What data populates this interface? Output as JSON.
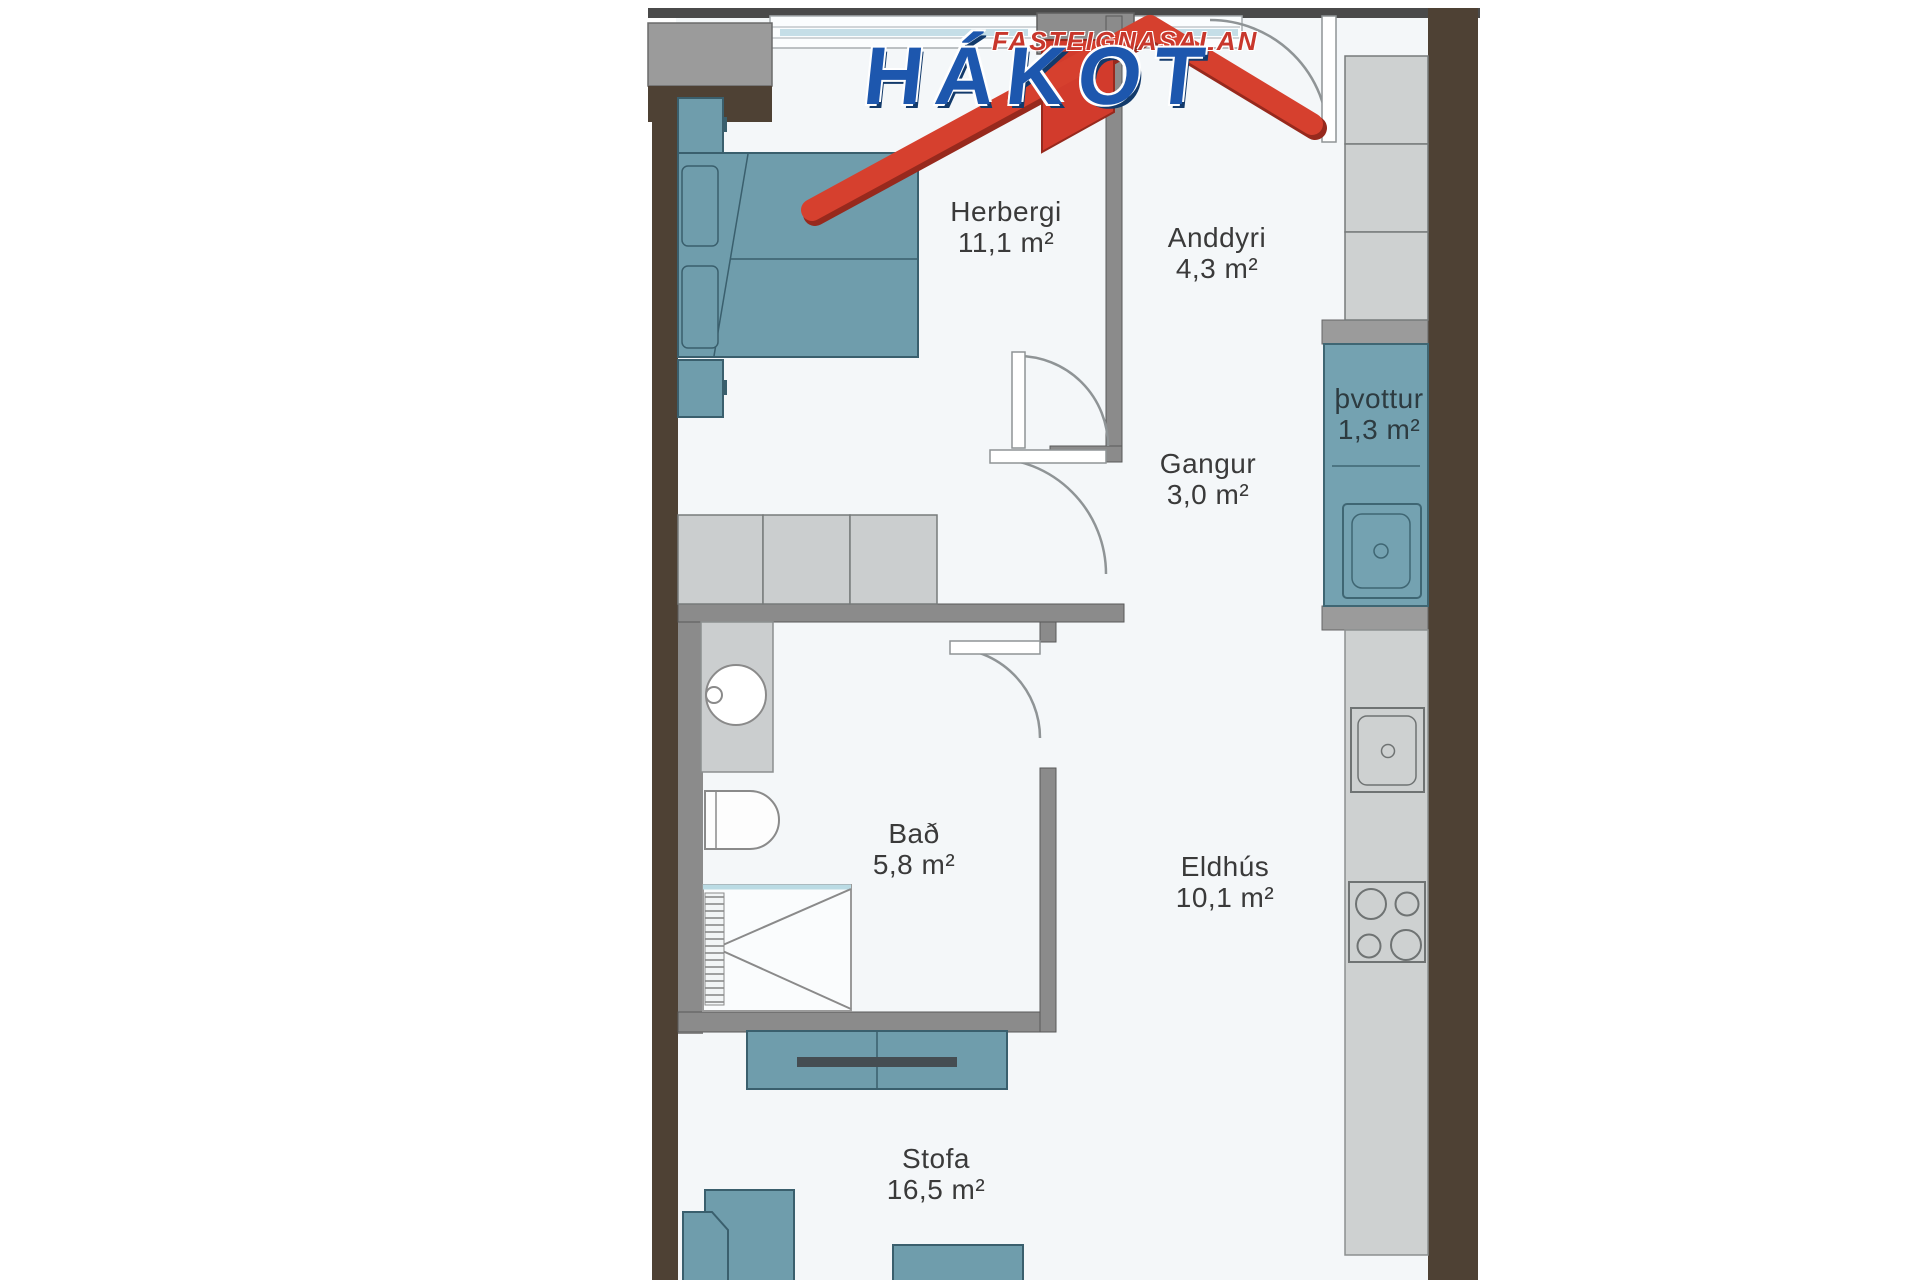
{
  "brand": {
    "tagline": "FASTEIGNASALAN",
    "name": "HÁKOT"
  },
  "rooms": [
    {
      "name": "Herbergi",
      "area": "11,1 m²"
    },
    {
      "name": "Anddyri",
      "area": "4,3 m²"
    },
    {
      "name": "Gangur",
      "area": "3,0 m²"
    },
    {
      "name": "þvottur",
      "area": "1,3 m²"
    },
    {
      "name": "Bað",
      "area": "5,8 m²"
    },
    {
      "name": "Eldhús",
      "area": "10,1 m²"
    },
    {
      "name": "Stofa",
      "area": "16,5 m²"
    }
  ],
  "colors": {
    "furniture_teal": "#6f9dac",
    "laundry_teal": "#74a2b1",
    "teal_outline": "#3a5f6d",
    "wall_brown": "#4e4134",
    "wall_gray": "#8b8b8b",
    "cabinet_gray": "#ced1d1",
    "floor": "#f4f7f9",
    "window_blue": "#c5dee7",
    "logo_red": "#d6402e",
    "logo_blue": "#1d57ae",
    "label_text": "#3a3a3a"
  },
  "fixtures": [
    "double-bed",
    "pillow",
    "nightstand",
    "wardrobe",
    "vanity-sink",
    "toilet",
    "shower",
    "washing-machine",
    "kitchen-sink",
    "stove",
    "kitchen-cabinets",
    "kitchen-counter",
    "tv-unit",
    "tv",
    "sofa",
    "coffee-table",
    "door-arc",
    "window"
  ]
}
